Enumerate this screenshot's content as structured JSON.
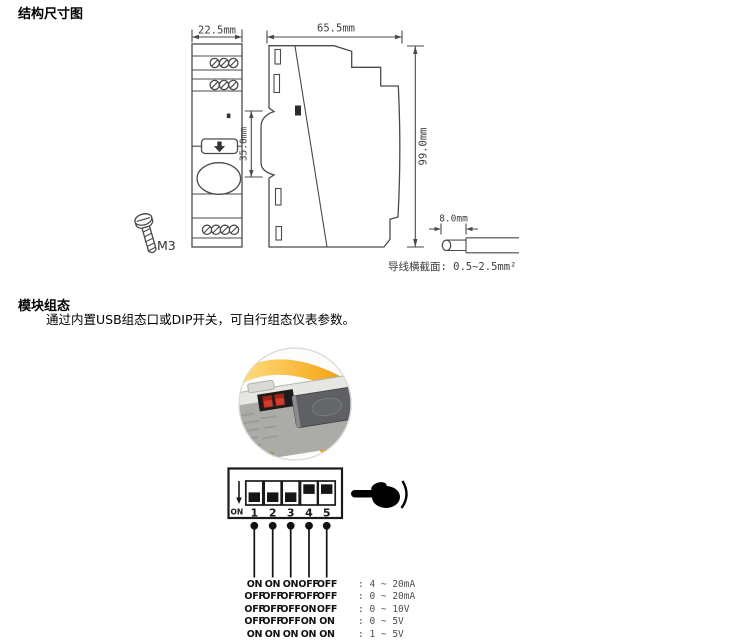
{
  "sections": {
    "structure": {
      "title": "结构尺寸图"
    },
    "config": {
      "title": "模块组态",
      "description": "通过内置USB组态口或DIP开关，可自行组态仪表参数。"
    }
  },
  "drawing": {
    "front_width": "22.5mm",
    "side_depth": "65.5mm",
    "rail_height": "35.0mm",
    "body_height": "99.0mm",
    "strip_length": "8.0mm",
    "screw_label": "M3",
    "wire_note": "导线横截面: 0.5~2.5mm²"
  },
  "dip": {
    "on_label": "ON",
    "numbers": [
      "1",
      "2",
      "3",
      "4",
      "5"
    ],
    "states": [
      "on",
      "on",
      "on",
      "off",
      "off"
    ],
    "table": [
      {
        "s": [
          "ON",
          "ON",
          "ON",
          "OFF",
          "OFF"
        ],
        "range": ": 4 ~ 20mA"
      },
      {
        "s": [
          "OFF",
          "OFF",
          "OFF",
          "OFF",
          "OFF"
        ],
        "range": ": 0 ~ 20mA"
      },
      {
        "s": [
          "OFF",
          "OFF",
          "OFF",
          "ON",
          "OFF"
        ],
        "range": ": 0 ~ 10V"
      },
      {
        "s": [
          "OFF",
          "OFF",
          "OFF",
          "ON",
          "ON"
        ],
        "range": ": 0 ~ 5V"
      },
      {
        "s": [
          "ON",
          "ON",
          "ON",
          "ON",
          "ON"
        ],
        "range": ": 1 ~ 5V"
      }
    ]
  },
  "colors": {
    "line": "#4a4a4a",
    "accent_yellow": "#f5a200",
    "switch_red": "#d13c2c"
  }
}
